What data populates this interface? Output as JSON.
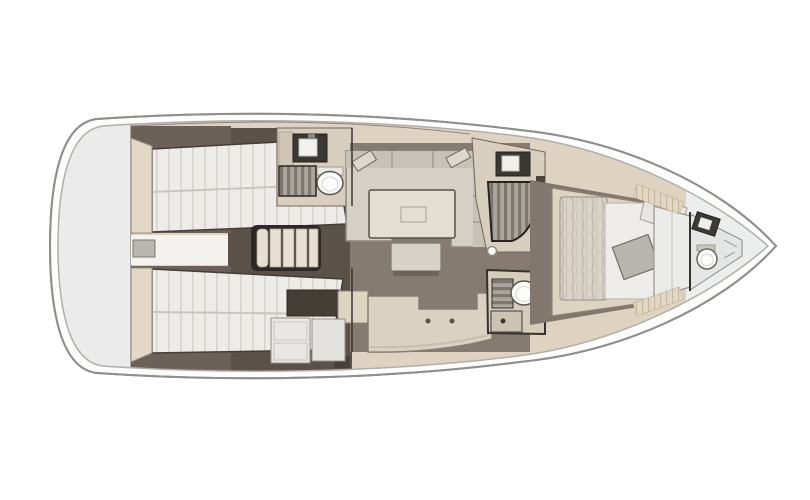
{
  "meta": {
    "type": "yacht-interior-floor-plan",
    "orientation": "bow-right",
    "view": "top-down"
  },
  "palette": {
    "background": "#ffffff",
    "hull_line": "#8f8f8f",
    "hull_inner_line": "#b0aeab",
    "stern_platform": "#ebebeb",
    "side_deck": "#ddd3c0",
    "floor_dark": "#5a5149",
    "floor_cabin": "#6b6158",
    "floor_salon": "#867b70",
    "mattress": "#edece8",
    "mattress_line": "#d7d3cc",
    "furniture_beige": "#dbd1c1",
    "wall_beige": "#d8cebd",
    "headboard": "#e2d8c6",
    "sofa": "#d5d0c5",
    "sofa_back": "#c7c2b7",
    "table": "#e3decf",
    "bench": "#d7d2c7",
    "counter_dark": "#463e36",
    "appliance_white": "#e9e7e3",
    "grate_light": "#aaa69e",
    "grate_dark": "#7c776f",
    "fixture_white": "#fcfcfb",
    "outline_dark": "#35312c",
    "blanket": "#d8d2c7",
    "throw_gray": "#b8b5af",
    "bow_room": "#eceeee",
    "steps_cream": "#e7dfd1",
    "stairs_well": "#2c2823"
  },
  "rooms": [
    {
      "id": "stern-platform",
      "label": "Stern and transom platform"
    },
    {
      "id": "aft-cabin-port",
      "label": "Aft port cabin with double berth"
    },
    {
      "id": "aft-cabin-starboard",
      "label": "Aft starboard cabin with double berth"
    },
    {
      "id": "engine-space",
      "label": "Engine space between aft cabins"
    },
    {
      "id": "companionway-stairs",
      "label": "Companionway stairs"
    },
    {
      "id": "head-port",
      "label": "Port head with sink, shower grate and toilet"
    },
    {
      "id": "salon",
      "label": "Salon with U-shaped settee, table and bench"
    },
    {
      "id": "galley",
      "label": "L-shaped galley with counters and appliances"
    },
    {
      "id": "shower-starboard",
      "label": "Starboard shower stall"
    },
    {
      "id": "head-starboard",
      "label": "Starboard head with toilet and sink"
    },
    {
      "id": "forward-cabin",
      "label": "Forward owner cabin with island berth"
    },
    {
      "id": "wardrobe-bulkhead",
      "label": "Forward wardrobe bulkhead"
    },
    {
      "id": "bow-head",
      "label": "Bow head with toilet and sink"
    }
  ]
}
